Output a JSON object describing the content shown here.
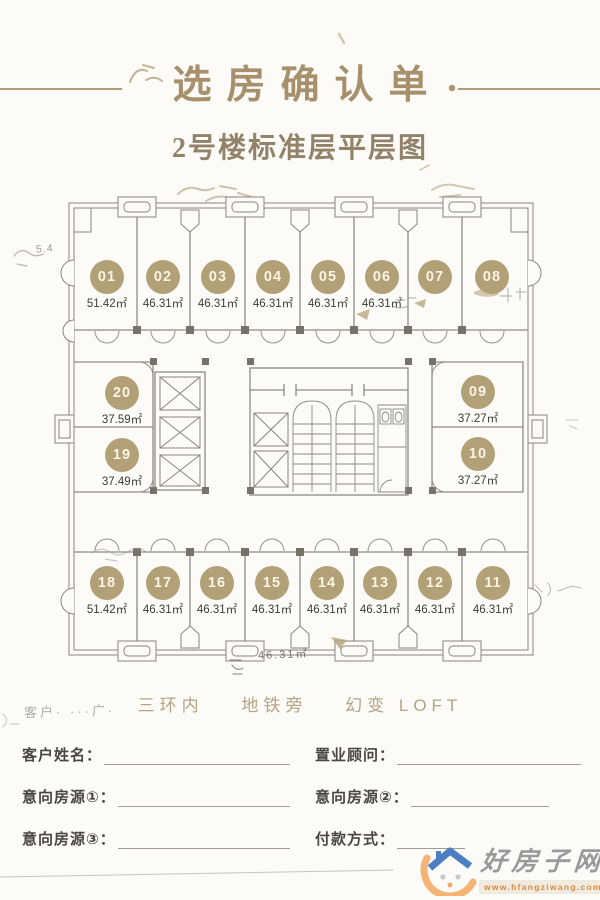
{
  "page": {
    "bg_color": "#fcfbf8",
    "accent_color": "#a7916c",
    "title": "选房确认单",
    "subtitle": "2号楼标准层平层图",
    "tagline": [
      "三环内",
      "地铁旁",
      "幻变 LOFT"
    ]
  },
  "floor_plan": {
    "badge_color": "#b2a077",
    "units": [
      {
        "id": "01",
        "area": "51.42㎡"
      },
      {
        "id": "02",
        "area": "46.31㎡"
      },
      {
        "id": "03",
        "area": "46.31㎡"
      },
      {
        "id": "04",
        "area": "46.31㎡"
      },
      {
        "id": "05",
        "area": "46.31㎡"
      },
      {
        "id": "06",
        "area": "46.31㎡"
      },
      {
        "id": "07",
        "area": ""
      },
      {
        "id": "08",
        "area": ""
      },
      {
        "id": "09",
        "area": "37.27㎡"
      },
      {
        "id": "10",
        "area": "37.27㎡"
      },
      {
        "id": "11",
        "area": "46.31㎡"
      },
      {
        "id": "12",
        "area": "46.31㎡"
      },
      {
        "id": "13",
        "area": "46.31㎡"
      },
      {
        "id": "14",
        "area": "46.31㎡"
      },
      {
        "id": "15",
        "area": "46.31㎡"
      },
      {
        "id": "16",
        "area": "46.31㎡"
      },
      {
        "id": "17",
        "area": "46.31㎡"
      },
      {
        "id": "18",
        "area": "51.42㎡"
      },
      {
        "id": "19",
        "area": "37.49㎡"
      },
      {
        "id": "20",
        "area": "37.59㎡"
      }
    ],
    "annotations": {
      "dim_left": "5.4",
      "dim_bottom": "46.31㎡"
    }
  },
  "form": {
    "ghost_text": "客户· ···广·",
    "fields": [
      {
        "label": "客户姓名："
      },
      {
        "label": "置业顾问："
      },
      {
        "label": "意向房源①："
      },
      {
        "label": "意向房源②："
      },
      {
        "label": "意向房源③："
      },
      {
        "label": "付款方式："
      }
    ]
  },
  "watermark": {
    "site_name": "好房子网",
    "site_url": "www.hfangziwang.com"
  }
}
